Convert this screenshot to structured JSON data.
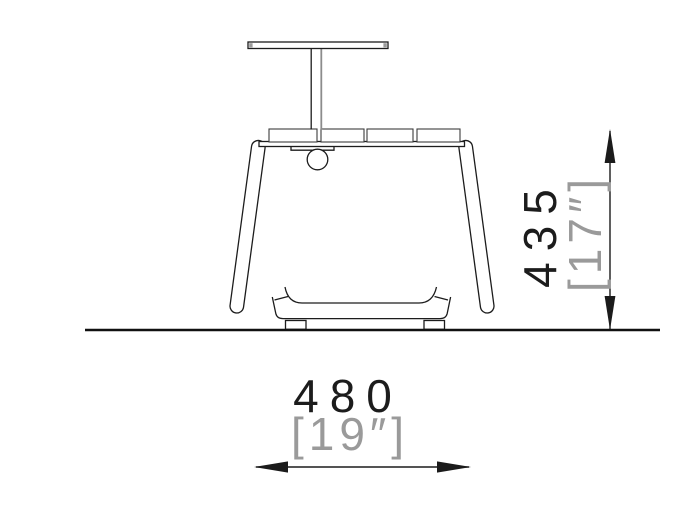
{
  "page": {
    "background": "#ffffff"
  },
  "drawing": {
    "type": "technical-side-elevation",
    "subject": "planter-bench-with-table-post",
    "colors": {
      "line": "#1c1c1c",
      "dim_primary_text": "#1c1c1c",
      "dim_secondary_text": "#9a9a9a"
    },
    "dimensions": {
      "height": {
        "mm": "435",
        "inches": "[17″]"
      },
      "width": {
        "mm": "480",
        "inches": "[19″]"
      }
    }
  }
}
